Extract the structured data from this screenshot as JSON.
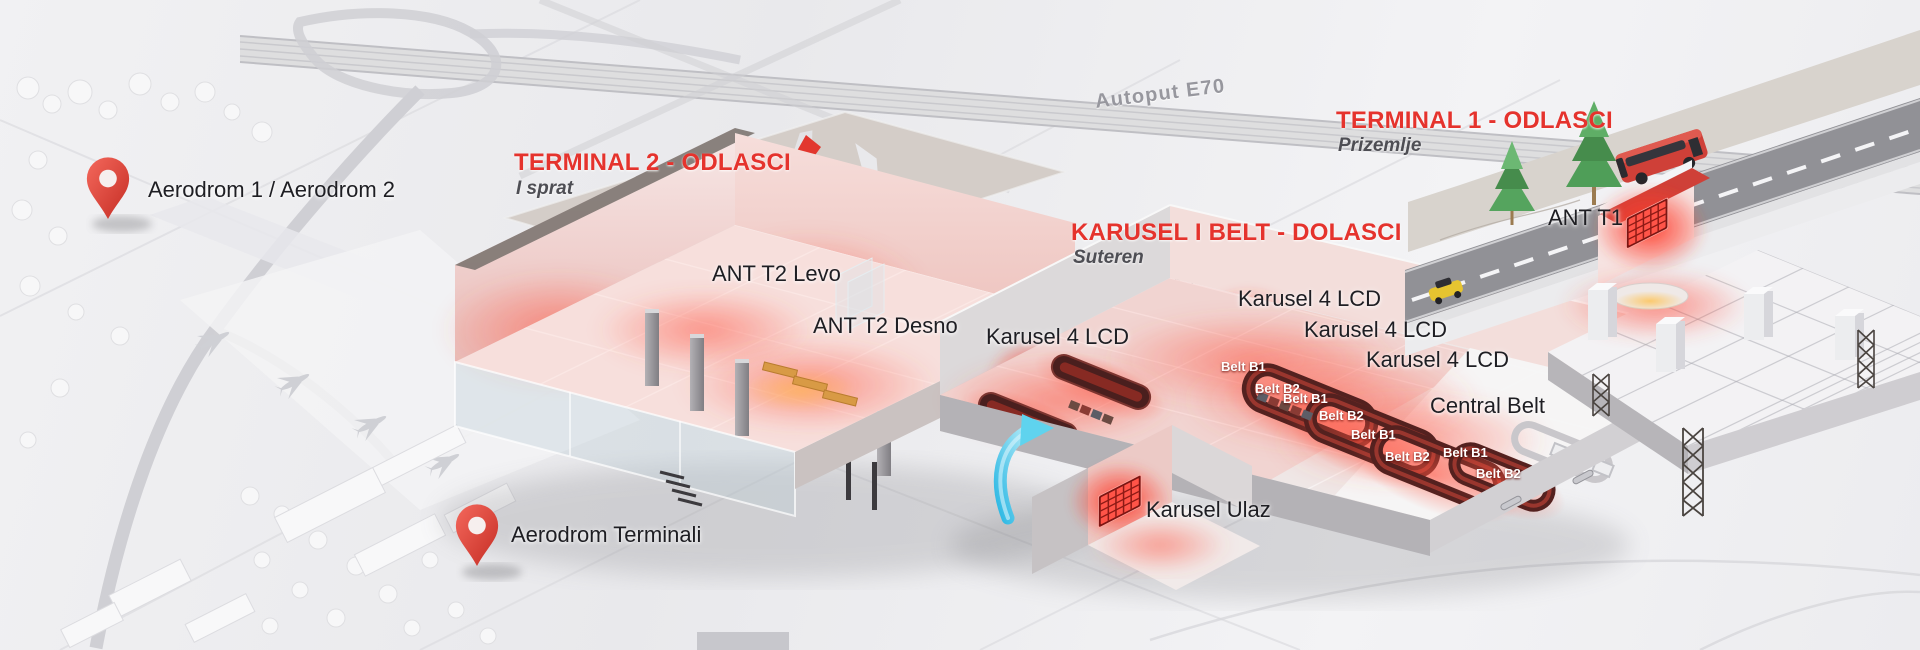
{
  "colors": {
    "accent_red": "#e5332d",
    "led_red": "#ff5448",
    "pin_red": "#e04a3f",
    "arrow_cyan": "#4fc9e9",
    "text_dark": "#1e1e23",
    "subtitle_gray": "#4e4e54",
    "highway_label_gray": "#97979e"
  },
  "pins": [
    {
      "label": "Aerodrom 1 / Aerodrom 2"
    },
    {
      "label": "Aerodrom Terminali"
    }
  ],
  "highway": {
    "label": "Autoput E70"
  },
  "sections": {
    "terminal2": {
      "title": "TERMINAL 2 - ODLASCI",
      "subtitle": "I sprat"
    },
    "terminal1": {
      "title": "TERMINAL 1 - ODLASCI",
      "subtitle": "Prizemlje"
    },
    "karusel": {
      "title": "KARUSEL I BELT - DOLASCI",
      "subtitle": "Suteren"
    }
  },
  "screens": {
    "ant_t2_levo": "ANT T2 Levo",
    "ant_t2_desno": "ANT T2 Desno",
    "ant_t1": "ANT T1",
    "karusel_lcd_left": "Karusel 4 LCD",
    "karusel_lcd_1": "Karusel 4 LCD",
    "karusel_lcd_2": "Karusel 4 LCD",
    "karusel_lcd_3": "Karusel 4 LCD",
    "karusel_ulaz": "Karusel Ulaz",
    "central_belt": "Central Belt"
  },
  "belts": [
    {
      "text": "Belt B1"
    },
    {
      "text": "Belt B2"
    },
    {
      "text": "Belt B1"
    },
    {
      "text": "Belt B2"
    },
    {
      "text": "Belt B1"
    },
    {
      "text": "Belt B2"
    },
    {
      "text": "Belt B1"
    },
    {
      "text": "Belt B2"
    }
  ]
}
